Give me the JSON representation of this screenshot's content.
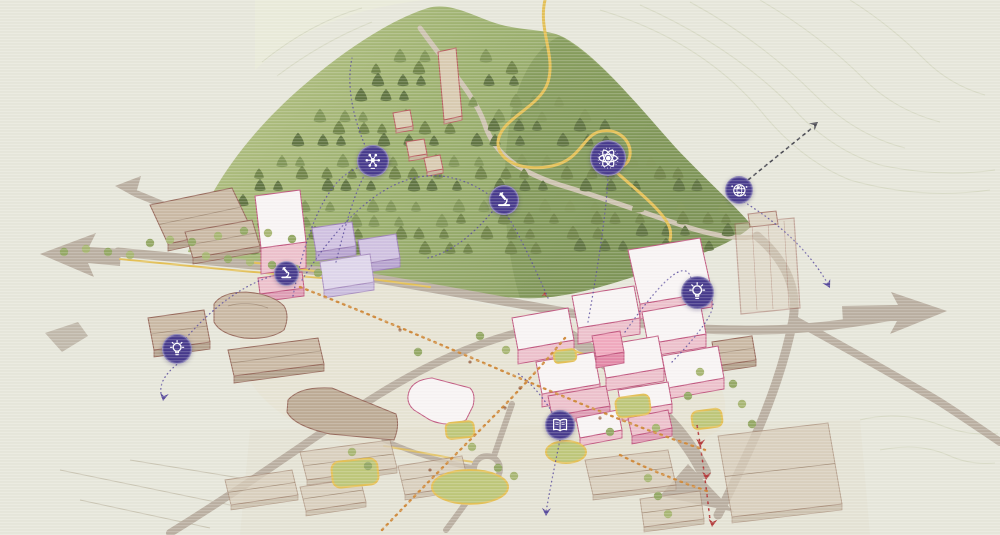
{
  "map": {
    "type": "isometric-campus-masterplan-illustration",
    "icons": [
      {
        "id": "brain-network",
        "label": "brain-network-icon",
        "x": 372,
        "y": 160,
        "d": 30
      },
      {
        "id": "atom",
        "label": "atom-icon",
        "x": 607,
        "y": 157,
        "d": 34
      },
      {
        "id": "microscope",
        "label": "microscope-icon",
        "x": 503,
        "y": 199,
        "d": 28
      },
      {
        "id": "globe",
        "label": "globe-network-icon",
        "x": 738,
        "y": 189,
        "d": 26
      },
      {
        "id": "microscope",
        "label": "microscope-icon",
        "x": 285,
        "y": 272,
        "d": 23
      },
      {
        "id": "lightbulb",
        "label": "lightbulb-icon",
        "x": 696,
        "y": 291,
        "d": 31
      },
      {
        "id": "lightbulb",
        "label": "lightbulb-icon",
        "x": 176,
        "y": 348,
        "d": 28
      },
      {
        "id": "book",
        "label": "open-book-icon",
        "x": 559,
        "y": 424,
        "d": 28
      }
    ],
    "trajectory_arrowheads": [
      {
        "x": 163,
        "y": 401,
        "angle": 100,
        "color": "purple"
      },
      {
        "x": 546,
        "y": 516,
        "angle": 93,
        "color": "purple"
      },
      {
        "x": 830,
        "y": 288,
        "angle": 62,
        "color": "purple"
      },
      {
        "x": 818,
        "y": 122,
        "angle": -38,
        "color": "dark"
      },
      {
        "x": 700,
        "y": 447,
        "angle": 95,
        "color": "red"
      },
      {
        "x": 706,
        "y": 480,
        "angle": 95,
        "color": "red"
      },
      {
        "x": 712,
        "y": 527,
        "angle": 97,
        "color": "red"
      },
      {
        "x": 545,
        "y": 292,
        "angle": -80,
        "color": "red",
        "small": true
      }
    ]
  },
  "colors": {
    "background": "#e6e6da",
    "badge": "#46398b",
    "badge_glyph": "#ffffff",
    "hill_green": "#a9b97e",
    "hill_dark": "#6f8748",
    "conifer": "#6d8348",
    "road_grey": "#b9aea0",
    "path_yellow": "#e3bf55",
    "route_orange": "#cf8a3c",
    "route_red": "#b23a3a",
    "arc_purple": "#584a9b",
    "dark_arrow": "#4a4a52",
    "existing_tan": "#c9b8a3",
    "existing_outline": "#96685a",
    "new_top": "#f8f4f4",
    "new_side": "#ecc0cb",
    "new_outline": "#c0577f",
    "purple_roof": "#cfc0e0",
    "lawn": "#bdc678",
    "contour": "#d4d6c0"
  }
}
